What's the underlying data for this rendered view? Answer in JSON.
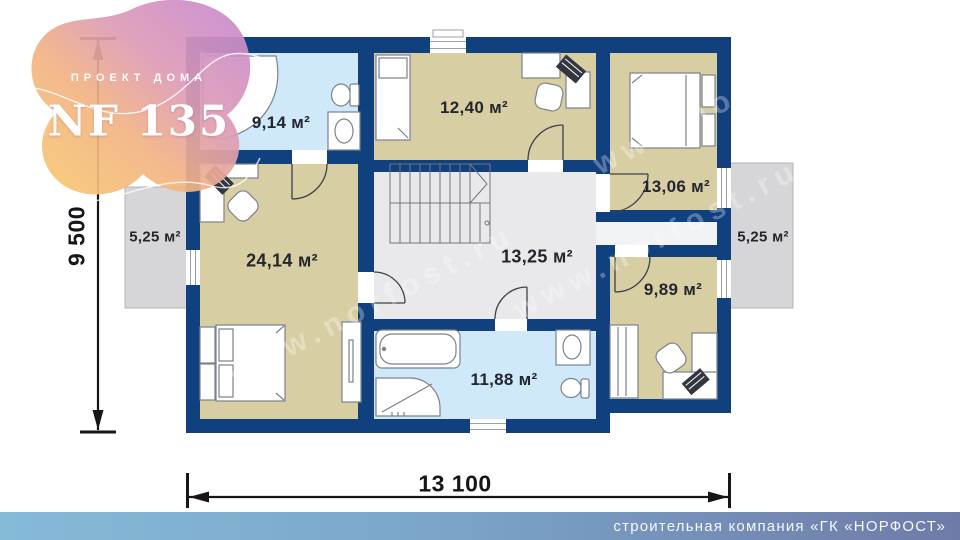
{
  "logo": {
    "project_label": "ПРОЕКТ ДОМА",
    "model": "NF 135"
  },
  "dimensions": {
    "width_mm": "13 100",
    "height_mm": "9 500"
  },
  "rooms": [
    {
      "id": "bathroom-upper",
      "area": "9,14 м²"
    },
    {
      "id": "bedroom-upper",
      "area": "12,40 м²"
    },
    {
      "id": "bedroom-right",
      "area": "13,06 м²"
    },
    {
      "id": "bedroom-master",
      "area": "24,14 м²"
    },
    {
      "id": "hall",
      "area": "13,25 м²"
    },
    {
      "id": "bathroom-lower",
      "area": "11,88 м²"
    },
    {
      "id": "room-lower-right",
      "area": "9,89 м²"
    },
    {
      "id": "balcony-left",
      "area": "5,25 м²"
    },
    {
      "id": "balcony-right",
      "area": "5,25 м²"
    }
  ],
  "watermark": {
    "text": "www.norfost.ru"
  },
  "footer": {
    "company": "строительная компания «ГК «НОРФОСТ»"
  },
  "colors": {
    "wall": "#11407f",
    "room_beige": "#d8cea4",
    "bathroom_blue": "#cfe8fa",
    "hall_gray": "#e9e9eb",
    "corridor_light": "#f2f3f5",
    "balcony_gray": "#d6d6d8",
    "footer_gradient_left": "#86bad9",
    "footer_gradient_right": "#6f7aa7",
    "logo_pink": "#c687d2",
    "logo_yellow": "#f8ca70",
    "dimension_text": "#15161a"
  }
}
